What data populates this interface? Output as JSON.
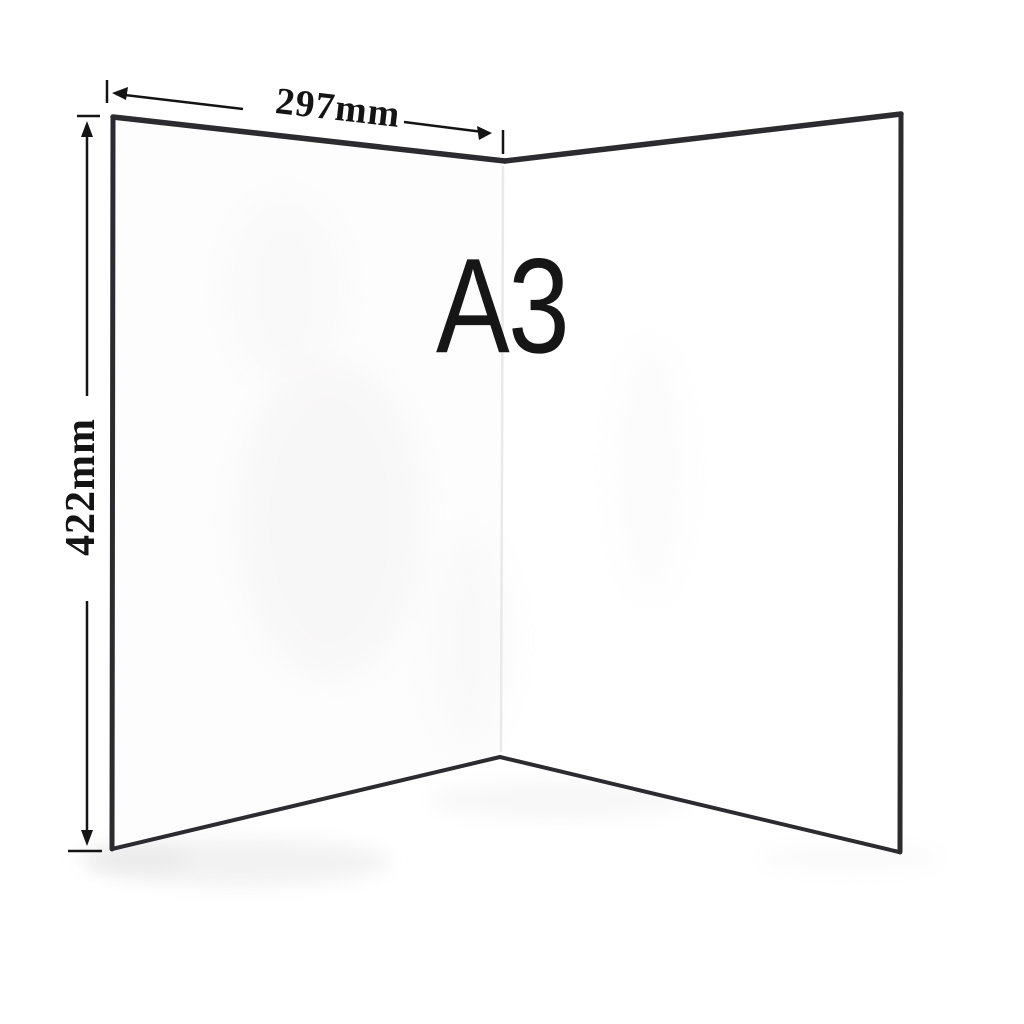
{
  "diagram": {
    "size_label": "A3",
    "width_label": "297mm",
    "height_label": "422mm"
  },
  "icons": {
    "width_dimension": "double-headed-arrow-horizontal",
    "height_dimension": "double-headed-arrow-vertical"
  },
  "colors": {
    "background": "#ffffff",
    "board_edge": "#2b2b30",
    "fold_line": "#e9e9e9",
    "panel_fill": "#fdfdfd",
    "annotation": "#141414"
  }
}
